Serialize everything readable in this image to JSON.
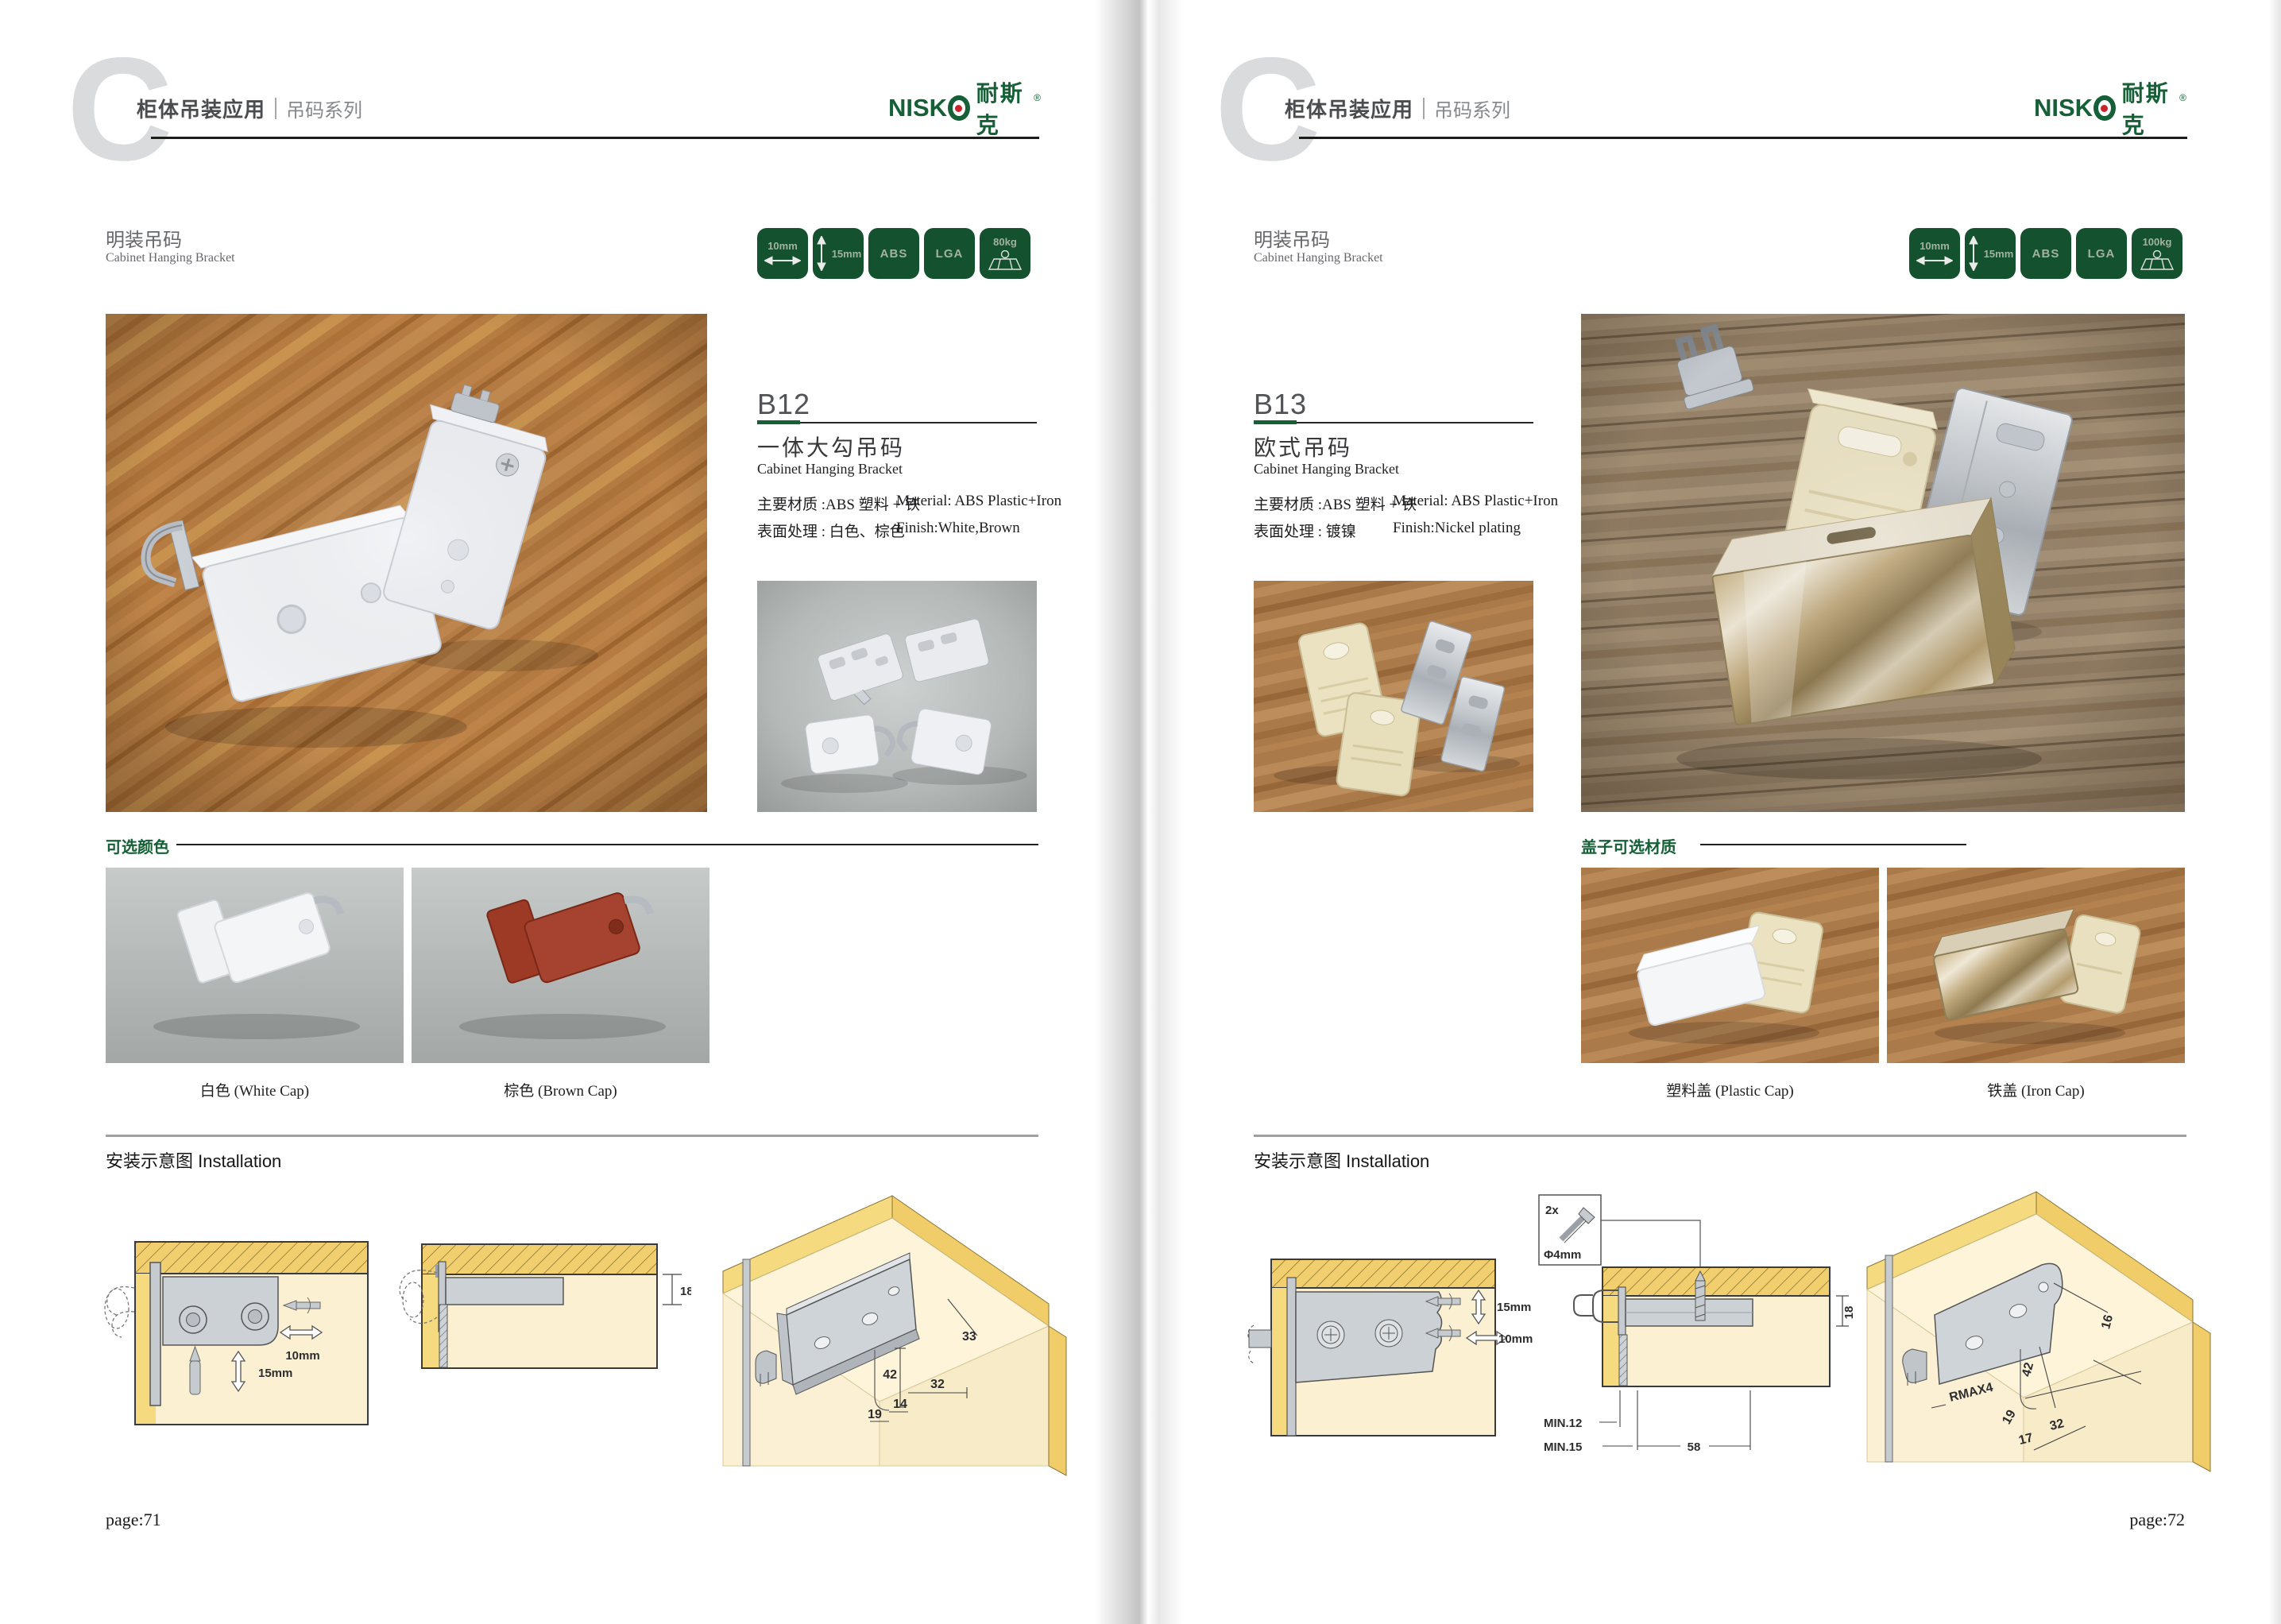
{
  "brand": {
    "latin_ni": "NI",
    "latin_sk": "SK",
    "cn": "耐斯克",
    "registered": "®"
  },
  "colors": {
    "brand_green": "#156036",
    "badge_green": "#14512e",
    "logo_red": "#c8242b",
    "option_label_green": "#156036"
  },
  "left": {
    "chapter_letter": "C",
    "header": {
      "title": "柜体吊装应用",
      "series": "吊码系列"
    },
    "section": {
      "cn": "明装吊码",
      "en": "Cabinet Hanging Bracket"
    },
    "badges": {
      "width": "10mm",
      "height": "15mm",
      "material": "ABS",
      "cert": "LGA",
      "load": "80kg"
    },
    "product": {
      "code": "B12",
      "cn": "一体大勾吊码",
      "en": "Cabinet Hanging Bracket",
      "material_cn": "主要材质 :ABS 塑料 + 铁",
      "material_en": "Material: ABS Plastic+Iron",
      "finish_cn": "表面处理 : 白色、棕色",
      "finish_en": "Finish:White,Brown"
    },
    "options": {
      "label": "可选颜色",
      "caption1": "白色 (White Cap)",
      "caption2": "棕色 (Brown Cap)"
    },
    "install": {
      "label": "安装示意图 Installation",
      "d1_width": "10mm",
      "d1_height": "15mm",
      "d2_depth": "18",
      "d3_33": "33",
      "d3_42": "42",
      "d3_32": "32",
      "d3_14": "14",
      "d3_19": "19"
    },
    "page_number": "page:71"
  },
  "right": {
    "chapter_letter": "C",
    "header": {
      "title": "柜体吊装应用",
      "series": "吊码系列"
    },
    "section": {
      "cn": "明装吊码",
      "en": "Cabinet Hanging Bracket"
    },
    "badges": {
      "width": "10mm",
      "height": "15mm",
      "material": "ABS",
      "cert": "LGA",
      "load": "100kg"
    },
    "product": {
      "code": "B13",
      "cn": "欧式吊码",
      "en": "Cabinet Hanging Bracket",
      "material_cn": "主要材质 :ABS 塑料 + 铁",
      "material_en": "Material: ABS Plastic+Iron",
      "finish_cn": "表面处理 : 镀镍",
      "finish_en": "Finish:Nickel plating"
    },
    "options": {
      "label": "盖子可选材质",
      "caption1": "塑料盖 (Plastic Cap)",
      "caption2": "铁盖 (Iron Cap)"
    },
    "install": {
      "label": "安装示意图 Installation",
      "d1_height": "15mm",
      "d1_width": "10mm",
      "d2_qty": "2x",
      "d2_dia": "Φ4mm",
      "d2_depth": "18",
      "d2_min12": "MIN.12",
      "d2_min15": "MIN.15",
      "d2_58": "58",
      "d3_16": "16",
      "d3_42": "42",
      "d3_rmax": "RMAX4",
      "d3_19": "19",
      "d3_17": "17",
      "d3_32": "32"
    },
    "page_number": "page:72"
  }
}
